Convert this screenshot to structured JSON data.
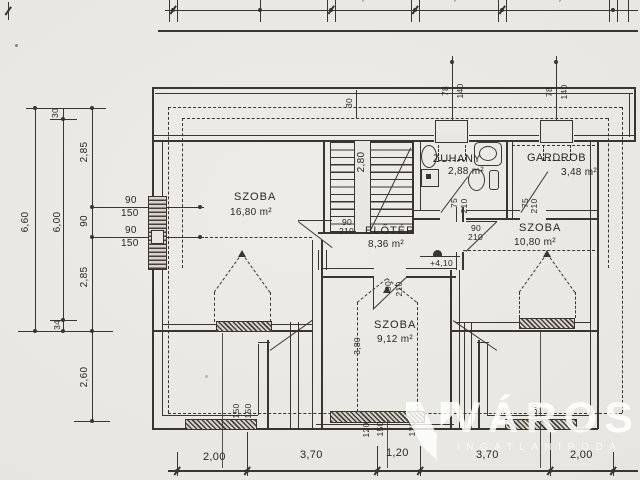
{
  "watermark": {
    "title": "VÁROSI",
    "subtitle": "INGATLANIRODA"
  },
  "rooms": {
    "szoba_left": {
      "name": "SZOBA",
      "area": "16,80 m²"
    },
    "eloter": {
      "name": "ELŐTÉR",
      "area": "8,36 m²"
    },
    "zuhany": {
      "name": "ZUHANY",
      "area": "2,88 m²"
    },
    "gardrob": {
      "name": "GARDROB",
      "area": "3,48 m²"
    },
    "szoba_right": {
      "name": "SZOBA",
      "area": "10,80 m²"
    },
    "szoba_bottom": {
      "name": "SZOBA",
      "area": "9,12 m²"
    }
  },
  "levels": {
    "attic": "+4,10"
  },
  "dims": {
    "top": [
      "2,20",
      "2,40",
      "2,90"
    ],
    "bottom": [
      "2,00",
      "3,70",
      "1,20",
      "3,70",
      "2,00"
    ],
    "left": {
      "total": "6,60",
      "inner": "6,00",
      "top_offset": "30",
      "bottom_offset": "34",
      "seg_upper": "2,85",
      "seg_window": "90",
      "seg_lower": "2,85",
      "below": "2,60"
    },
    "left_windows": [
      {
        "w": "90",
        "h": "150"
      },
      {
        "w": "90",
        "h": "150"
      }
    ],
    "top_windows": [
      {
        "w": "78",
        "h": "140"
      },
      {
        "w": "78",
        "h": "140"
      }
    ],
    "wall_offset": "30",
    "stair_rise": "2,80",
    "room_depth": "3,80",
    "doors": {
      "eloter": {
        "w": "90",
        "h": "210"
      },
      "zuhany": {
        "w": "75",
        "h": "210"
      },
      "gardrob": {
        "w": "75",
        "h": "210"
      },
      "szoba_right": {
        "w": "90",
        "h": "210"
      },
      "szoba_bottom": {
        "w": "90",
        "h": "210"
      }
    },
    "center_window": [
      "120",
      "150",
      "120"
    ],
    "axis_marks": [
      "150",
      "150",
      "150"
    ]
  }
}
